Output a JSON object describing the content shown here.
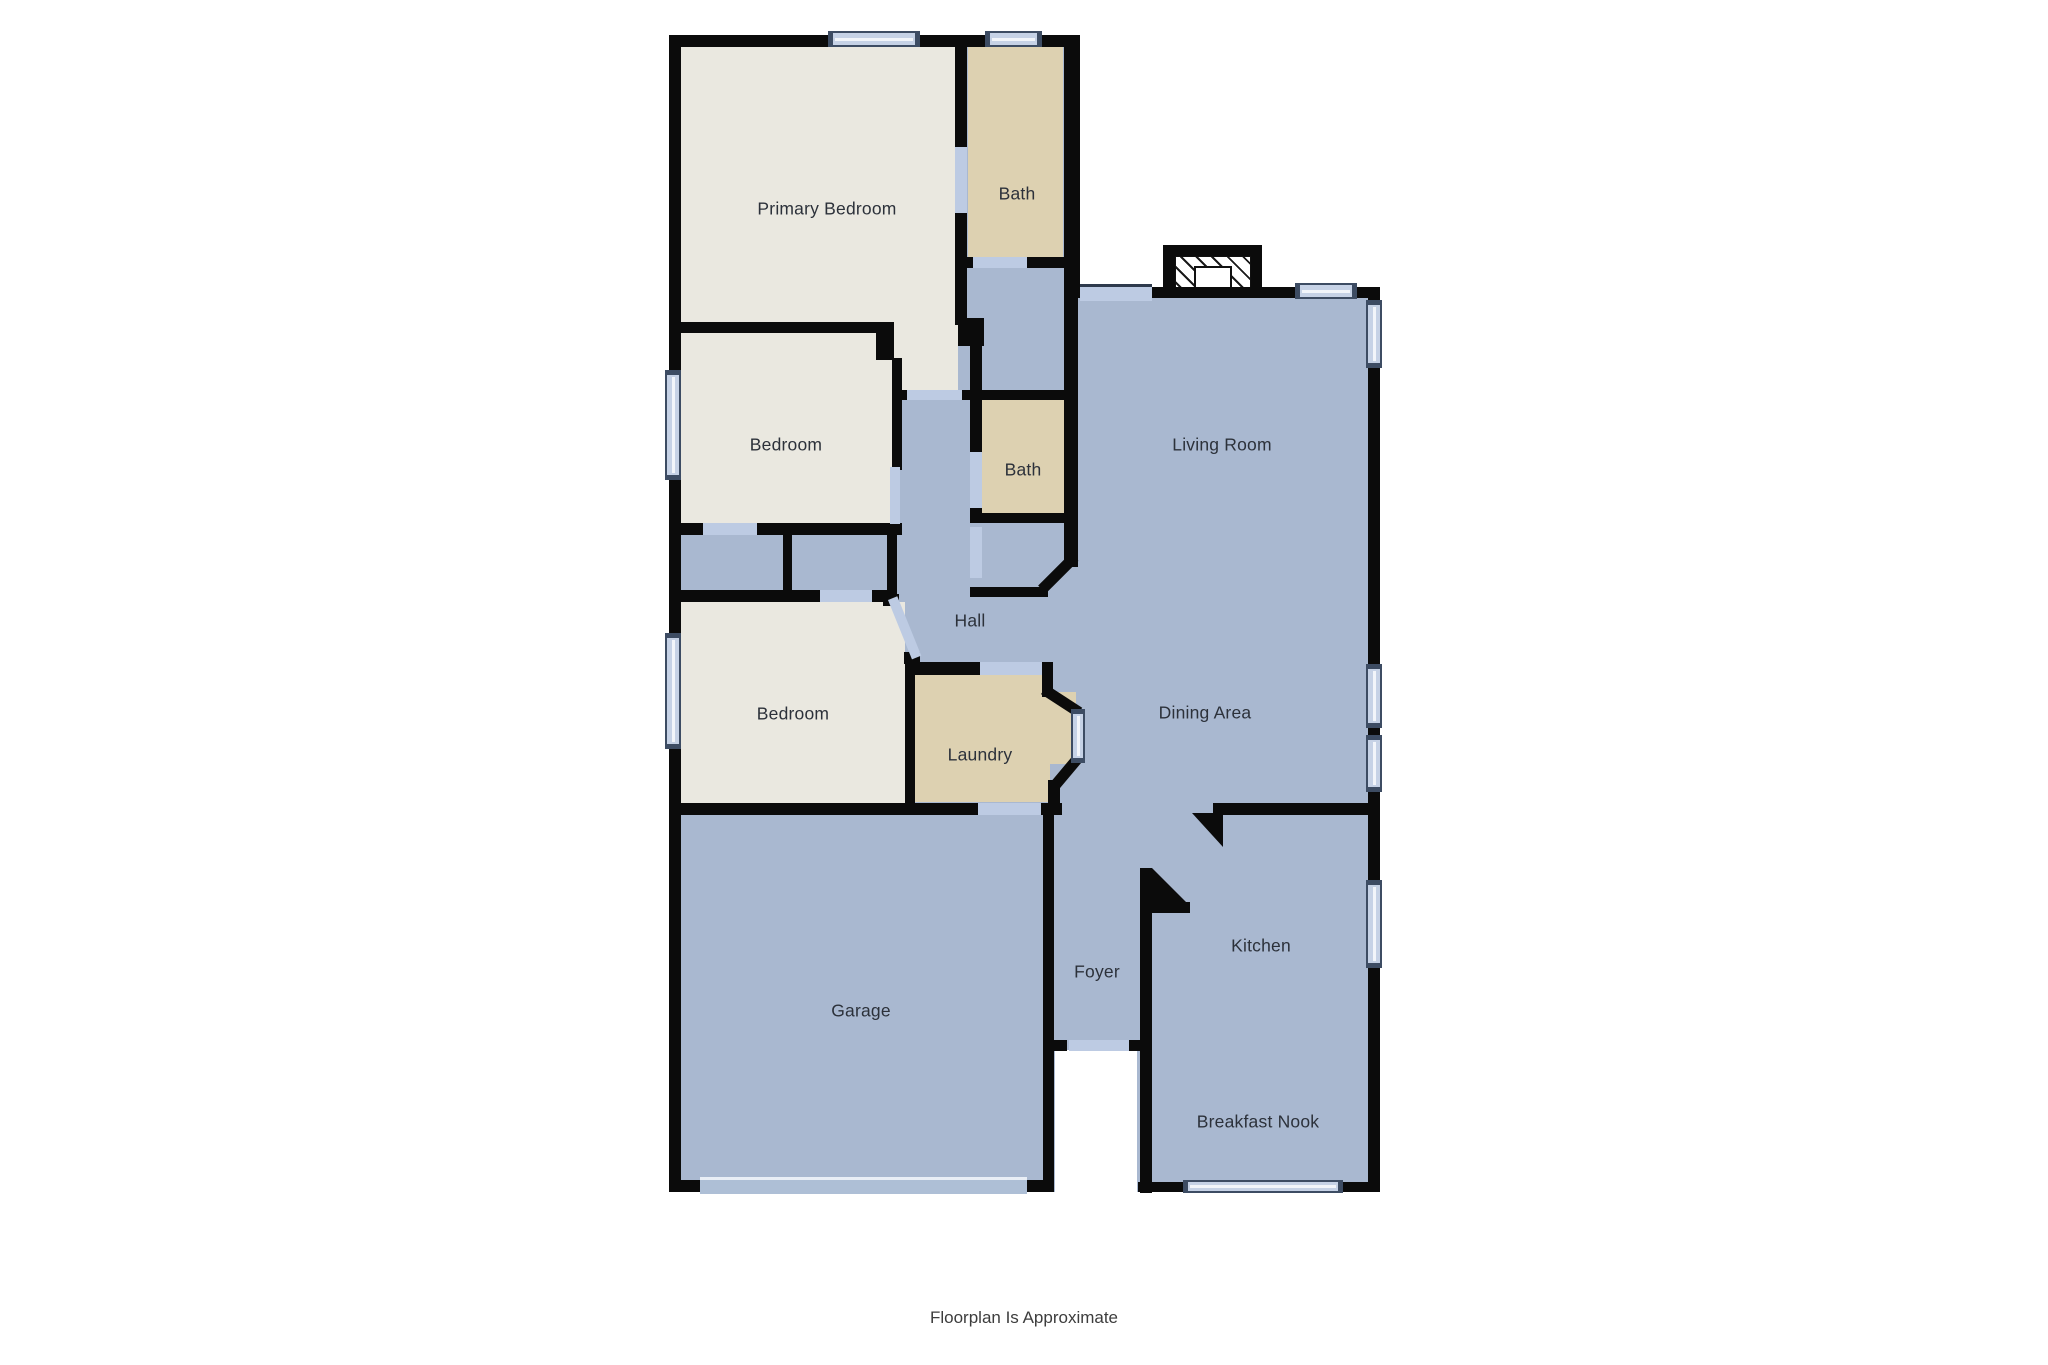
{
  "title": "Floorplan",
  "rooms": {
    "primary_bedroom": {
      "label": "Primary Bedroom"
    },
    "bath1": {
      "label": "Bath"
    },
    "bedroom1": {
      "label": "Bedroom"
    },
    "bath2": {
      "label": "Bath"
    },
    "living_room": {
      "label": "Living Room"
    },
    "hall": {
      "label": "Hall"
    },
    "bedroom2": {
      "label": "Bedroom"
    },
    "laundry": {
      "label": "Laundry"
    },
    "dining_area": {
      "label": "Dining Area"
    },
    "garage": {
      "label": "Garage"
    },
    "foyer": {
      "label": "Foyer"
    },
    "kitchen": {
      "label": "Kitchen"
    },
    "breakfast_nook": {
      "label": "Breakfast Nook"
    }
  },
  "footer": {
    "note": "Floorplan Is Approximate"
  },
  "colors": {
    "wall": "#0b0b0b",
    "room_blue": "#a9b8d0",
    "room_beige": "#eae8e0",
    "room_tan": "#ddd1b1",
    "door_blue": "#bdcbe3",
    "garage_door": "#aebfd6",
    "window_fill": "#c6d2e6",
    "window_frame": "#3d4c63"
  }
}
